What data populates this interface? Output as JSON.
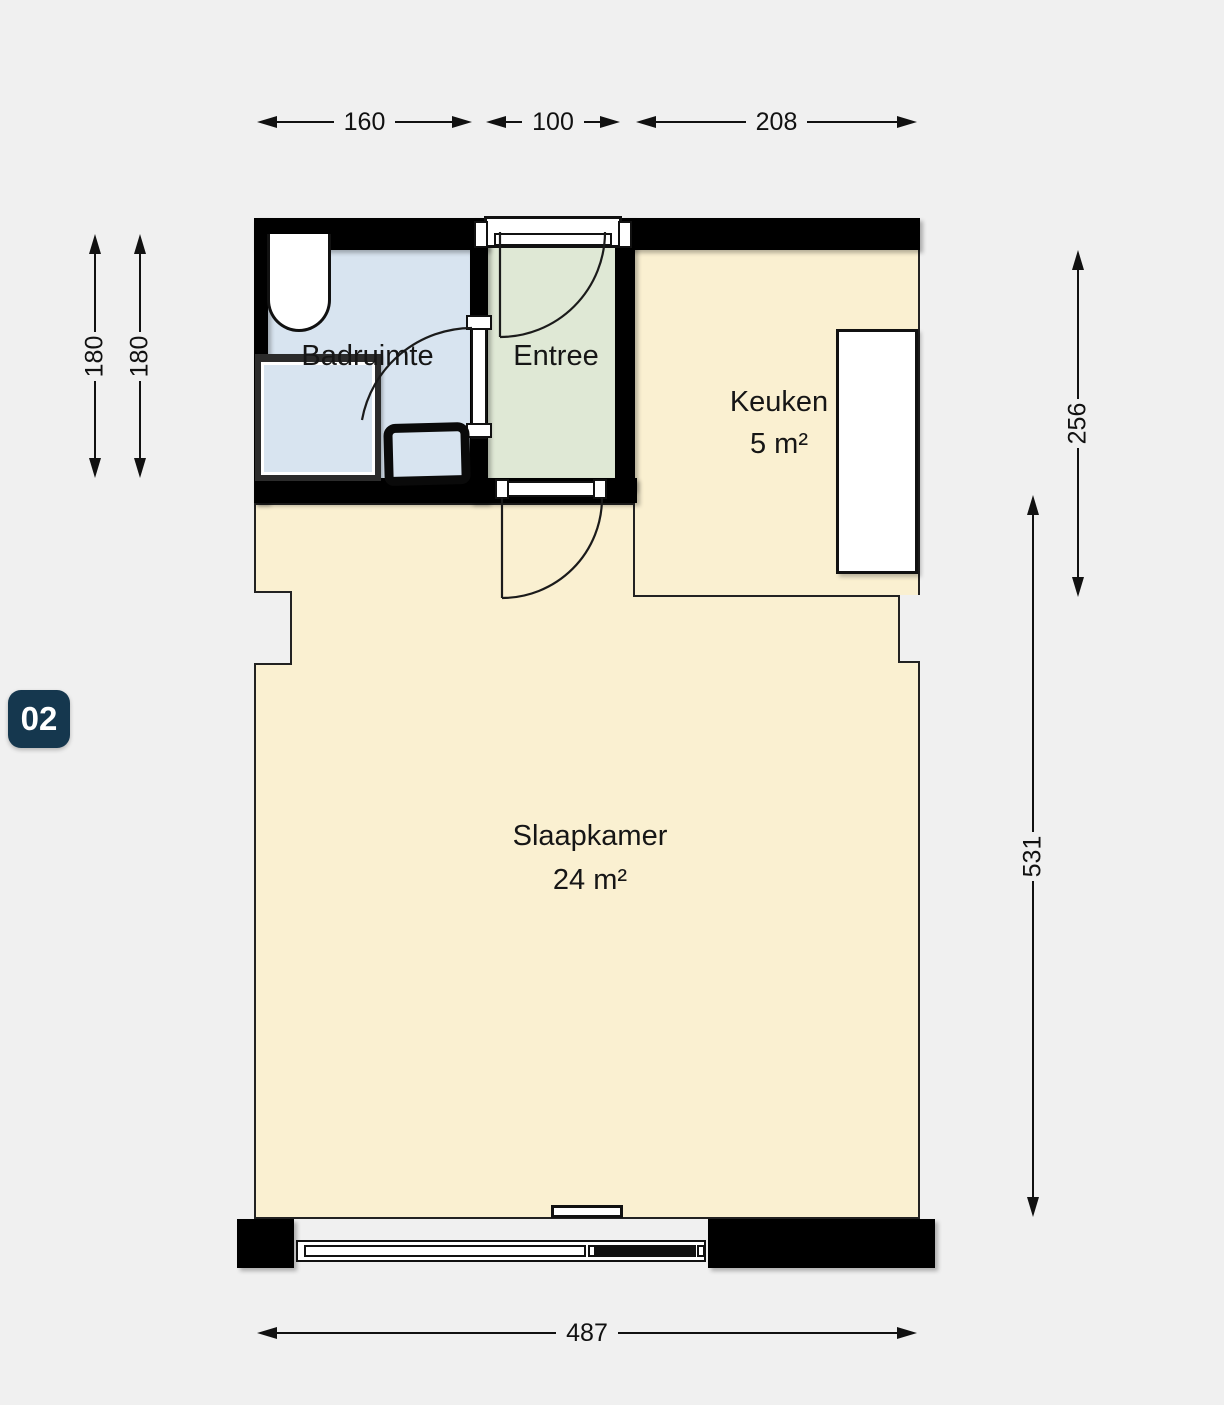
{
  "badge": {
    "label": "02"
  },
  "rooms": {
    "badruimte": {
      "name": "Badruimte"
    },
    "entree": {
      "name": "Entree"
    },
    "keuken": {
      "name": "Keuken",
      "area": "5 m²"
    },
    "slaapkamer": {
      "name": "Slaapkamer",
      "area": "24 m²"
    }
  },
  "dimensions": {
    "top": [
      {
        "value": "160"
      },
      {
        "value": "100"
      },
      {
        "value": "208"
      }
    ],
    "left": [
      {
        "value": "180"
      },
      {
        "value": "180"
      }
    ],
    "right": [
      {
        "value": "256"
      },
      {
        "value": "531"
      }
    ],
    "bottom": [
      {
        "value": "487"
      }
    ]
  },
  "colors": {
    "background": "#f0f0f0",
    "wall": "#000000",
    "badruimte_floor": "#d8e4f0",
    "entree_floor": "#dfe8d5",
    "living_floor": "#faf0d1",
    "badge_background": "#15374e",
    "badge_text": "#ffffff",
    "dimension_line": "#111111"
  }
}
